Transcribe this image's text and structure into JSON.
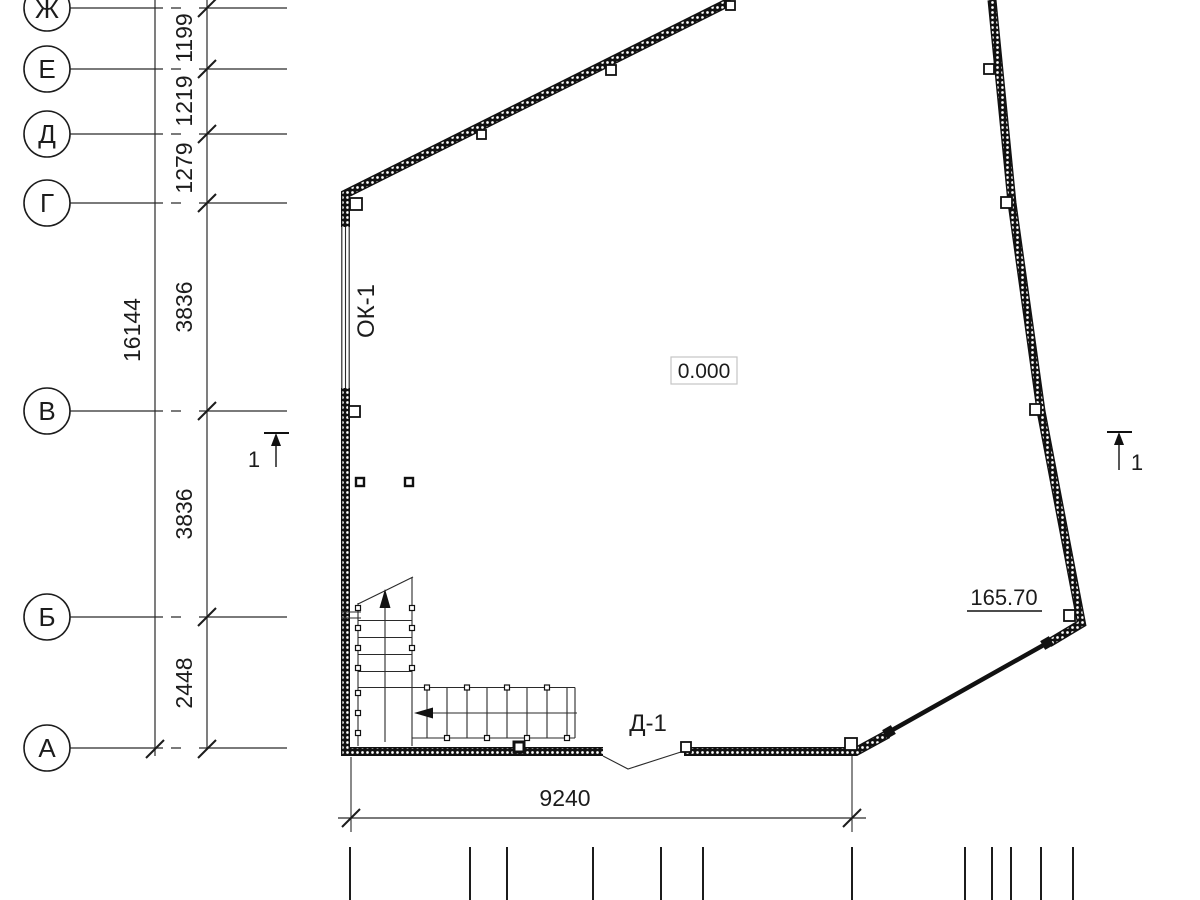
{
  "axes": [
    {
      "label": "Ж"
    },
    {
      "label": "Е"
    },
    {
      "label": "Д"
    },
    {
      "label": "Г"
    },
    {
      "label": "В"
    },
    {
      "label": "Б"
    },
    {
      "label": "А"
    }
  ],
  "dims": {
    "total_left": "16144",
    "chain_left": [
      "1199",
      "1219",
      "1279",
      "3836",
      "3836",
      "2448"
    ],
    "bottom": "9240"
  },
  "labels": {
    "floor_elevation": "0.000",
    "site_elevation": "165.70",
    "window_mark": "ОК-1",
    "door_mark": "Д-1",
    "section_number_left": "1",
    "section_number_right": "1"
  },
  "colors": {
    "line": "#1c1c1c",
    "background": "#ffffff",
    "elevation_box_border": "#c4c4c4"
  }
}
